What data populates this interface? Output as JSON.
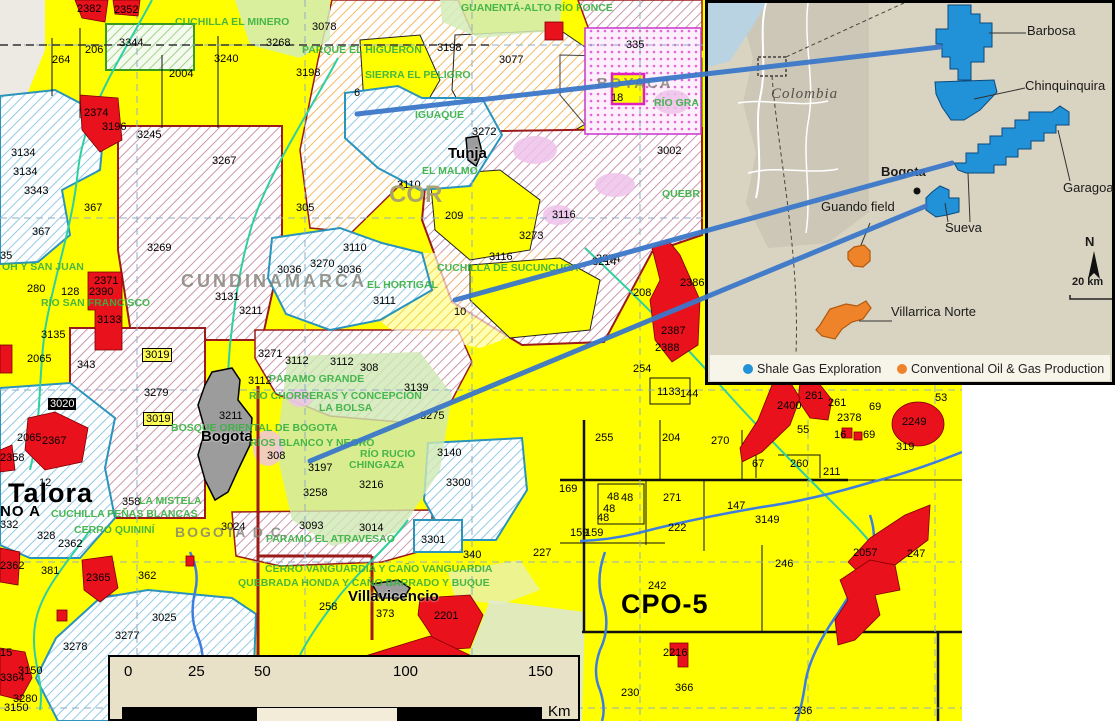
{
  "colors": {
    "block_yellow": "#ffff00",
    "block_red": "#e8111c",
    "shale_blue": "#2191d8",
    "conventional_orange": "#ef8329",
    "connector_blue": "#3c78c9",
    "park_green": "#39b143",
    "inset_bg": "#d9d3c1",
    "hatch_maroon": "#c07d97",
    "hatch_orange": "#f2a93b",
    "hatch_blue": "#79bddd"
  },
  "map": {
    "blocks": [
      {
        "t": "2382",
        "x": 77,
        "y": 3
      },
      {
        "t": "2352",
        "x": 114,
        "y": 4
      },
      {
        "t": "3344",
        "x": 119,
        "y": 37
      },
      {
        "t": "206",
        "x": 85,
        "y": 44
      },
      {
        "t": "264",
        "x": 52,
        "y": 54
      },
      {
        "t": "2004",
        "x": 169,
        "y": 68
      },
      {
        "t": "3240",
        "x": 214,
        "y": 53
      },
      {
        "t": "3268",
        "x": 266,
        "y": 37
      },
      {
        "t": "3078",
        "x": 312,
        "y": 21
      },
      {
        "t": "3198",
        "x": 296,
        "y": 67
      },
      {
        "t": "3198",
        "x": 437,
        "y": 42
      },
      {
        "t": "3077",
        "x": 499,
        "y": 54
      },
      {
        "t": "335",
        "x": 626,
        "y": 39
      },
      {
        "t": "18",
        "x": 611,
        "y": 92
      },
      {
        "t": "6",
        "x": 354,
        "y": 87
      },
      {
        "t": "2374",
        "x": 84,
        "y": 107
      },
      {
        "t": "3196",
        "x": 102,
        "y": 121
      },
      {
        "t": "3245",
        "x": 137,
        "y": 129
      },
      {
        "t": "3134",
        "x": 11,
        "y": 147
      },
      {
        "t": "3134",
        "x": 13,
        "y": 166
      },
      {
        "t": "3343",
        "x": 24,
        "y": 185
      },
      {
        "t": "3267",
        "x": 212,
        "y": 155
      },
      {
        "t": "367",
        "x": 84,
        "y": 202
      },
      {
        "t": "367",
        "x": 32,
        "y": 226
      },
      {
        "t": "3269",
        "x": 147,
        "y": 242
      },
      {
        "t": "305",
        "x": 296,
        "y": 202
      },
      {
        "t": "3272",
        "x": 472,
        "y": 126
      },
      {
        "t": "3002",
        "x": 657,
        "y": 145
      },
      {
        "t": "3110",
        "x": 397,
        "y": 179
      },
      {
        "t": "209",
        "x": 445,
        "y": 210
      },
      {
        "t": "3116",
        "x": 552,
        "y": 209
      },
      {
        "t": "3273",
        "x": 519,
        "y": 230
      },
      {
        "t": "3116",
        "x": 489,
        "y": 251
      },
      {
        "t": "3274",
        "x": 596,
        "y": 253
      },
      {
        "t": "3110",
        "x": 343,
        "y": 242
      },
      {
        "t": "3036",
        "x": 277,
        "y": 264
      },
      {
        "t": "3270",
        "x": 310,
        "y": 258
      },
      {
        "t": "3036",
        "x": 337,
        "y": 264
      },
      {
        "t": "3111",
        "x": 373,
        "y": 295
      },
      {
        "t": "10",
        "x": 454,
        "y": 306
      },
      {
        "t": "3211",
        "x": 239,
        "y": 305
      },
      {
        "t": "3131",
        "x": 215,
        "y": 291
      },
      {
        "t": "2371",
        "x": 94,
        "y": 275
      },
      {
        "t": "2390",
        "x": 89,
        "y": 286
      },
      {
        "t": "128",
        "x": 61,
        "y": 286
      },
      {
        "t": "280",
        "x": 27,
        "y": 283
      },
      {
        "t": "35",
        "x": 0,
        "y": 250
      },
      {
        "t": "3133",
        "x": 97,
        "y": 314
      },
      {
        "t": "3135",
        "x": 41,
        "y": 329
      },
      {
        "t": "2065",
        "x": 27,
        "y": 353
      },
      {
        "t": "343",
        "x": 77,
        "y": 359
      },
      {
        "t": "3019",
        "x": 142,
        "y": 348,
        "cls": "boxed"
      },
      {
        "t": "3279",
        "x": 144,
        "y": 387
      },
      {
        "t": "3019",
        "x": 143,
        "y": 412,
        "cls": "boxed"
      },
      {
        "t": "3020",
        "x": 48,
        "y": 398,
        "cls": "inv"
      },
      {
        "t": "2065",
        "x": 17,
        "y": 432
      },
      {
        "t": "2367",
        "x": 42,
        "y": 435
      },
      {
        "t": "2358",
        "x": 0,
        "y": 452
      },
      {
        "t": "12",
        "x": 39,
        "y": 477
      },
      {
        "t": "358",
        "x": 122,
        "y": 496
      },
      {
        "t": "3271",
        "x": 258,
        "y": 348
      },
      {
        "t": "3112",
        "x": 285,
        "y": 355
      },
      {
        "t": "3112",
        "x": 330,
        "y": 356
      },
      {
        "t": "3112",
        "x": 248,
        "y": 375
      },
      {
        "t": "308",
        "x": 360,
        "y": 362
      },
      {
        "t": "3139",
        "x": 404,
        "y": 382
      },
      {
        "t": "3275",
        "x": 420,
        "y": 410
      },
      {
        "t": "3211",
        "x": 219,
        "y": 410
      },
      {
        "t": "308",
        "x": 267,
        "y": 450
      },
      {
        "t": "3197",
        "x": 308,
        "y": 462
      },
      {
        "t": "3216",
        "x": 359,
        "y": 479
      },
      {
        "t": "3140",
        "x": 437,
        "y": 447
      },
      {
        "t": "3300",
        "x": 446,
        "y": 477
      },
      {
        "t": "3258",
        "x": 303,
        "y": 487
      },
      {
        "t": "3024",
        "x": 221,
        "y": 521
      },
      {
        "t": "3093",
        "x": 299,
        "y": 520
      },
      {
        "t": "3014",
        "x": 359,
        "y": 522
      },
      {
        "t": "3301",
        "x": 421,
        "y": 534
      },
      {
        "t": "328",
        "x": 37,
        "y": 530
      },
      {
        "t": "2362",
        "x": 58,
        "y": 538
      },
      {
        "t": "332",
        "x": 0,
        "y": 519
      },
      {
        "t": "2362",
        "x": 0,
        "y": 560
      },
      {
        "t": "381",
        "x": 41,
        "y": 565
      },
      {
        "t": "2365",
        "x": 86,
        "y": 572
      },
      {
        "t": "362",
        "x": 138,
        "y": 570
      },
      {
        "t": "3025",
        "x": 152,
        "y": 612
      },
      {
        "t": "3277",
        "x": 115,
        "y": 630
      },
      {
        "t": "3278",
        "x": 63,
        "y": 641
      },
      {
        "t": "3150",
        "x": 18,
        "y": 665
      },
      {
        "t": "3364",
        "x": 0,
        "y": 672
      },
      {
        "t": "3280",
        "x": 13,
        "y": 693
      },
      {
        "t": "3150",
        "x": 4,
        "y": 702
      },
      {
        "t": "15",
        "x": 0,
        "y": 647
      },
      {
        "t": "258",
        "x": 319,
        "y": 601
      },
      {
        "t": "373",
        "x": 376,
        "y": 608
      },
      {
        "t": "2201",
        "x": 434,
        "y": 610
      },
      {
        "t": "340",
        "x": 463,
        "y": 549
      },
      {
        "t": "227",
        "x": 533,
        "y": 547
      },
      {
        "t": "3214",
        "x": 592,
        "y": 256
      },
      {
        "t": "254",
        "x": 633,
        "y": 363
      },
      {
        "t": "208",
        "x": 633,
        "y": 287
      },
      {
        "t": "2386",
        "x": 680,
        "y": 277
      },
      {
        "t": "2387",
        "x": 661,
        "y": 325
      },
      {
        "t": "2388",
        "x": 655,
        "y": 342
      },
      {
        "t": "1133",
        "x": 657,
        "y": 386
      },
      {
        "t": "144",
        "x": 680,
        "y": 388
      },
      {
        "t": "2400",
        "x": 777,
        "y": 400
      },
      {
        "t": "261",
        "x": 805,
        "y": 390
      },
      {
        "t": "261",
        "x": 828,
        "y": 397
      },
      {
        "t": "69",
        "x": 869,
        "y": 401
      },
      {
        "t": "2378",
        "x": 837,
        "y": 412
      },
      {
        "t": "55",
        "x": 797,
        "y": 424
      },
      {
        "t": "16",
        "x": 834,
        "y": 429
      },
      {
        "t": "69",
        "x": 863,
        "y": 429
      },
      {
        "t": "2249",
        "x": 902,
        "y": 416
      },
      {
        "t": "53",
        "x": 935,
        "y": 392
      },
      {
        "t": "319",
        "x": 896,
        "y": 441
      },
      {
        "t": "270",
        "x": 711,
        "y": 435
      },
      {
        "t": "255",
        "x": 595,
        "y": 432
      },
      {
        "t": "204",
        "x": 662,
        "y": 432
      },
      {
        "t": "67",
        "x": 752,
        "y": 458
      },
      {
        "t": "260",
        "x": 790,
        "y": 458
      },
      {
        "t": "211",
        "x": 823,
        "y": 466
      },
      {
        "t": "169",
        "x": 559,
        "y": 483
      },
      {
        "t": "48",
        "x": 607,
        "y": 491
      },
      {
        "t": "48",
        "x": 621,
        "y": 492
      },
      {
        "t": "48",
        "x": 603,
        "y": 503
      },
      {
        "t": "48",
        "x": 597,
        "y": 512
      },
      {
        "t": "271",
        "x": 663,
        "y": 492
      },
      {
        "t": "147",
        "x": 727,
        "y": 500
      },
      {
        "t": "222",
        "x": 668,
        "y": 522
      },
      {
        "t": "3149",
        "x": 755,
        "y": 514
      },
      {
        "t": "159",
        "x": 570,
        "y": 527
      },
      {
        "t": "159",
        "x": 585,
        "y": 527
      },
      {
        "t": "246",
        "x": 775,
        "y": 558
      },
      {
        "t": "2057",
        "x": 853,
        "y": 547
      },
      {
        "t": "247",
        "x": 907,
        "y": 548
      },
      {
        "t": "242",
        "x": 648,
        "y": 580
      },
      {
        "t": "230",
        "x": 621,
        "y": 687
      },
      {
        "t": "2216",
        "x": 663,
        "y": 647
      },
      {
        "t": "366",
        "x": 675,
        "y": 682
      },
      {
        "t": "236",
        "x": 794,
        "y": 705
      },
      {
        "t": "3299",
        "x": 547,
        "y": 655
      },
      {
        "t": "05",
        "x": 566,
        "y": 670
      }
    ],
    "parks": [
      {
        "t": "CUCHILLA EL MINERO",
        "x": 175,
        "y": 16
      },
      {
        "t": "GUANENTÁ-ALTO RÍO FONCE",
        "x": 461,
        "y": 2
      },
      {
        "t": "PARQUE EL HIGUERÓN",
        "x": 302,
        "y": 44
      },
      {
        "t": "SIERRA EL PELIGRO",
        "x": 365,
        "y": 69
      },
      {
        "t": "IGUAQUE",
        "x": 415,
        "y": 109
      },
      {
        "t": "RÍO GRA",
        "x": 654,
        "y": 97
      },
      {
        "t": "EL MALMO",
        "x": 422,
        "y": 165
      },
      {
        "t": "QUEBR",
        "x": 662,
        "y": 188
      },
      {
        "t": "CUCHILLA DE SUCUNCUCA",
        "x": 437,
        "y": 262
      },
      {
        "t": "EL HORTIGAL",
        "x": 367,
        "y": 279
      },
      {
        "t": "OH Y SAN JUAN",
        "x": 2,
        "y": 261
      },
      {
        "t": "RÍO SAN FRANCISCO",
        "x": 41,
        "y": 297
      },
      {
        "t": "PÁRAMO GRANDE",
        "x": 269,
        "y": 373
      },
      {
        "t": "RÍO CHORRERAS Y CONCEPCIÓN",
        "x": 249,
        "y": 390
      },
      {
        "t": "LA BOLSA",
        "x": 319,
        "y": 402
      },
      {
        "t": "BOSQUE ORIENTAL DE BOGOTA",
        "x": 171,
        "y": 422
      },
      {
        "t": "RÍOS BLANCO Y NEGRO",
        "x": 250,
        "y": 437
      },
      {
        "t": "RÍO RUCIO",
        "x": 360,
        "y": 448
      },
      {
        "t": "CHINGAZA",
        "x": 349,
        "y": 459
      },
      {
        "t": "LA MISTELA",
        "x": 139,
        "y": 495
      },
      {
        "t": "CUCHILLA PEÑAS BLANCAS",
        "x": 51,
        "y": 508
      },
      {
        "t": "CERRO QUININÍ",
        "x": 74,
        "y": 524
      },
      {
        "t": "PARAMO EL ATRAVESAO",
        "x": 266,
        "y": 533
      },
      {
        "t": "CERRO VANGUARDIA Y CAÑO VANGUARDIA",
        "x": 265,
        "y": 563
      },
      {
        "t": "QUEBRADA HONDA Y CAÑO BARRADO Y BUQUE",
        "x": 238,
        "y": 577
      },
      {
        "t": "SUMAPAZ",
        "x": 209,
        "y": 654
      }
    ],
    "regions": [
      {
        "t": "CUNDINAMARCA",
        "x": 181,
        "y": 271,
        "fs": 18,
        "ls": 3
      },
      {
        "t": "BOGOTA D.C.",
        "x": 175,
        "y": 524,
        "fs": 14,
        "ls": 2
      },
      {
        "t": "BOYACA",
        "x": 597,
        "y": 75,
        "fs": 15,
        "ls": 2
      },
      {
        "t": "COR",
        "x": 389,
        "y": 181,
        "fs": 24,
        "cls": "cor"
      }
    ],
    "cities": [
      {
        "t": "Tunja",
        "x": 448,
        "y": 145
      },
      {
        "t": "Bogota",
        "x": 201,
        "y": 428
      },
      {
        "t": "Villavicencio",
        "x": 348,
        "y": 588
      }
    ],
    "big_labels": [
      {
        "t": "Talora",
        "x": 8,
        "y": 478,
        "fs": 27
      },
      {
        "t": "NO A",
        "x": 0,
        "y": 503,
        "fs": 15
      },
      {
        "t": "CPO-5",
        "x": 621,
        "y": 589,
        "fs": 27
      }
    ]
  },
  "scalebar": {
    "ticks": [
      {
        "t": "0",
        "x": 14
      },
      {
        "t": "25",
        "x": 78
      },
      {
        "t": "50",
        "x": 144
      },
      {
        "t": "100",
        "x": 283
      },
      {
        "t": "150",
        "x": 418
      }
    ],
    "unit": "Km"
  },
  "inset": {
    "labels": [
      {
        "t": "Colombia",
        "x": 66,
        "y": 86,
        "cls": "colombia"
      },
      {
        "t": "Bogota",
        "x": 176,
        "y": 164,
        "cls": "ins-city"
      },
      {
        "t": "Barbosa",
        "x": 322,
        "y": 23
      },
      {
        "t": "Chinquinquira",
        "x": 320,
        "y": 78
      },
      {
        "t": "Garagoa",
        "x": 358,
        "y": 180
      },
      {
        "t": "Sueva",
        "x": 240,
        "y": 220
      },
      {
        "t": "Guando field",
        "x": 116,
        "y": 199
      },
      {
        "t": "Villarrica Norte",
        "x": 186,
        "y": 304
      },
      {
        "t": "N",
        "x": 380,
        "y": 234,
        "cls": "ins-n"
      },
      {
        "t": "20 km",
        "x": 367,
        "y": 276,
        "cls": "ins-scale"
      }
    ],
    "legend": [
      {
        "t": "Shale Gas Exploration",
        "x": 52,
        "y": 362,
        "cls": "lb"
      },
      {
        "t": "Conventional Oil & Gas Production",
        "x": 206,
        "y": 362,
        "cls": "lo"
      }
    ]
  }
}
